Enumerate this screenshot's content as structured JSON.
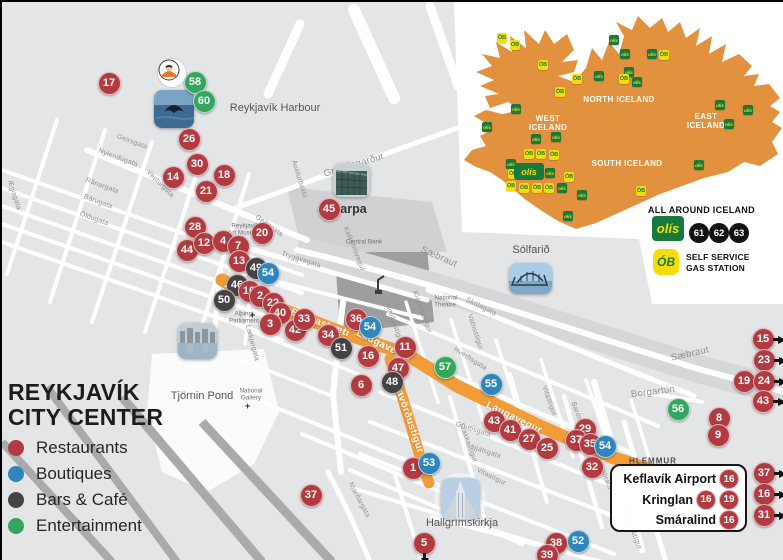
{
  "colors": {
    "restaurant": "#b13b41",
    "boutique": "#2f86ba",
    "bar": "#464244",
    "entertainment": "#34a65d",
    "route": "#f19c38",
    "iceland": "#e2913e",
    "olis_green": "#17793c",
    "olis_yellow": "#f5dd0a"
  },
  "city_legend": {
    "title_line1": "REYKJAVÍK",
    "title_line2": "CITY CENTER",
    "items": [
      {
        "label": "Restaurants",
        "color": "#b13b41"
      },
      {
        "label": "Boutiques",
        "color": "#2f86ba"
      },
      {
        "label": "Bars & Café",
        "color": "#464244"
      },
      {
        "label": "Entertainment",
        "color": "#34a65d"
      }
    ]
  },
  "map": {
    "street_labels": [
      {
        "t": "Grandagarður",
        "x": 352,
        "y": 163,
        "r": -17,
        "s": "md"
      },
      {
        "t": "Geirsgata",
        "x": 130,
        "y": 140,
        "r": 20,
        "s": "sm"
      },
      {
        "t": "Nýlendugata",
        "x": 116,
        "y": 156,
        "r": 20,
        "s": "sm"
      },
      {
        "t": "Ránargata",
        "x": 100,
        "y": 184,
        "r": 20,
        "s": "sm"
      },
      {
        "t": "Bárugata",
        "x": 96,
        "y": 200,
        "r": 20,
        "s": "sm"
      },
      {
        "t": "Öldugata",
        "x": 92,
        "y": 217,
        "r": 20,
        "s": "sm"
      },
      {
        "t": "Vesturgata",
        "x": 158,
        "y": 182,
        "r": 45,
        "s": "sm"
      },
      {
        "t": "Ægisgata",
        "x": 12,
        "y": 193,
        "r": 72,
        "s": "sm"
      },
      {
        "t": "Geirsgata",
        "x": 267,
        "y": 224,
        "r": 36,
        "s": "sm"
      },
      {
        "t": "Austurbakki",
        "x": 297,
        "y": 177,
        "r": 73,
        "s": "sm"
      },
      {
        "t": "Tryggvagata",
        "x": 299,
        "y": 258,
        "r": 18,
        "s": "sm"
      },
      {
        "t": "Kalkofnsvegur",
        "x": 352,
        "y": 247,
        "r": 68,
        "s": "sm"
      },
      {
        "t": "Sæbraut",
        "x": 437,
        "y": 255,
        "r": 24,
        "s": "md"
      },
      {
        "t": "Skúlagata",
        "x": 479,
        "y": 305,
        "r": 26,
        "s": "sm"
      },
      {
        "t": "Hverfisgata",
        "x": 468,
        "y": 357,
        "r": 32,
        "s": "sm"
      },
      {
        "t": "Klapparstígur",
        "x": 420,
        "y": 310,
        "r": 70,
        "s": "sm"
      },
      {
        "t": "Smiðjustígur",
        "x": 392,
        "y": 322,
        "r": 70,
        "s": "sm"
      },
      {
        "t": "Vatnsstígur",
        "x": 473,
        "y": 330,
        "r": 72,
        "s": "sm"
      },
      {
        "t": "Sæbraut",
        "x": 688,
        "y": 352,
        "r": -13,
        "s": "md"
      },
      {
        "t": "Borgartún",
        "x": 651,
        "y": 390,
        "r": -7,
        "s": "md"
      },
      {
        "t": "Vitastígur",
        "x": 547,
        "y": 399,
        "r": 70,
        "s": "sm"
      },
      {
        "t": "Frakkastígur",
        "x": 466,
        "y": 441,
        "r": 70,
        "s": "sm"
      },
      {
        "t": "Barónsstígur",
        "x": 578,
        "y": 420,
        "r": 70,
        "s": "sm"
      },
      {
        "t": "Snorrabraut",
        "x": 601,
        "y": 469,
        "r": 70,
        "s": "sm"
      },
      {
        "t": "Rauðarárstígur",
        "x": 629,
        "y": 524,
        "r": 70,
        "s": "sm"
      },
      {
        "t": "Njálsgata",
        "x": 484,
        "y": 450,
        "r": 18,
        "s": "sm"
      },
      {
        "t": "Grettisgata",
        "x": 471,
        "y": 428,
        "r": 18,
        "s": "sm"
      },
      {
        "t": "Njarðargata",
        "x": 357,
        "y": 498,
        "r": 62,
        "s": "sm"
      },
      {
        "t": "Vitastígur",
        "x": 489,
        "y": 475,
        "r": 26,
        "s": "sm"
      },
      {
        "t": "Lækjargata",
        "x": 250,
        "y": 341,
        "r": 75,
        "s": "sm"
      }
    ],
    "place_labels": [
      {
        "t": "Reykjavík Harbour",
        "x": 273,
        "y": 106,
        "r": 0,
        "s": "p"
      },
      {
        "t": "Harpa",
        "x": 347,
        "y": 207,
        "r": 0,
        "s": "pb"
      },
      {
        "t": "Tjörnin Pond",
        "x": 200,
        "y": 394,
        "r": 0,
        "s": "p"
      },
      {
        "t": "Sólfarið",
        "x": 529,
        "y": 248,
        "r": 0,
        "s": "p"
      },
      {
        "t": "Hallgrímskirkja",
        "x": 460,
        "y": 521,
        "r": 0,
        "s": "p"
      },
      {
        "t": "Central Bank",
        "x": 362,
        "y": 240,
        "r": 0,
        "s": "t"
      },
      {
        "t": "National",
        "x": 444,
        "y": 296,
        "r": 0,
        "s": "t"
      },
      {
        "t": "Theatre",
        "x": 443,
        "y": 303,
        "r": 0,
        "s": "t"
      },
      {
        "t": "Alþingi",
        "x": 242,
        "y": 312,
        "r": 0,
        "s": "t"
      },
      {
        "t": "Parliament",
        "x": 242,
        "y": 319,
        "r": 0,
        "s": "t"
      },
      {
        "t": "National",
        "x": 249,
        "y": 389,
        "r": 0,
        "s": "t"
      },
      {
        "t": "Gallery",
        "x": 249,
        "y": 396,
        "r": 0,
        "s": "t"
      },
      {
        "t": "Reykjavík",
        "x": 243,
        "y": 224,
        "r": 0,
        "s": "t"
      },
      {
        "t": "Art Museum",
        "x": 243,
        "y": 231,
        "r": 0,
        "s": "t"
      },
      {
        "t": "HLEMMUR",
        "x": 651,
        "y": 459,
        "r": 0,
        "s": "tc"
      }
    ],
    "route_labels": [
      {
        "t": "Austurstræti",
        "x": 253,
        "y": 294,
        "r": 21
      },
      {
        "t": "Bankastræti",
        "x": 318,
        "y": 321,
        "r": 21
      },
      {
        "t": "Laugavegur",
        "x": 382,
        "y": 344,
        "r": 26
      },
      {
        "t": "Skólavörðustígur",
        "x": 404,
        "y": 409,
        "r": 71
      },
      {
        "t": "Laugavegur",
        "x": 512,
        "y": 416,
        "r": 26
      }
    ],
    "markers": [
      {
        "n": "17",
        "x": 107,
        "y": 81,
        "c": "restaurant"
      },
      {
        "n": "58",
        "x": 193,
        "y": 80,
        "c": "entertainment"
      },
      {
        "n": "60",
        "x": 202,
        "y": 99,
        "c": "entertainment"
      },
      {
        "n": "26",
        "x": 187,
        "y": 137,
        "c": "restaurant"
      },
      {
        "n": "30",
        "x": 195,
        "y": 162,
        "c": "restaurant"
      },
      {
        "n": "14",
        "x": 171,
        "y": 175,
        "c": "restaurant"
      },
      {
        "n": "18",
        "x": 222,
        "y": 173,
        "c": "restaurant"
      },
      {
        "n": "21",
        "x": 204,
        "y": 189,
        "c": "restaurant"
      },
      {
        "n": "45",
        "x": 327,
        "y": 207,
        "c": "restaurant"
      },
      {
        "n": "28",
        "x": 193,
        "y": 225,
        "c": "restaurant"
      },
      {
        "n": "20",
        "x": 260,
        "y": 231,
        "c": "restaurant"
      },
      {
        "n": "44",
        "x": 185,
        "y": 248,
        "c": "restaurant"
      },
      {
        "n": "12",
        "x": 202,
        "y": 241,
        "c": "restaurant"
      },
      {
        "n": "4",
        "x": 221,
        "y": 239,
        "c": "restaurant"
      },
      {
        "n": "7",
        "x": 236,
        "y": 244,
        "c": "restaurant"
      },
      {
        "n": "13",
        "x": 237,
        "y": 259,
        "c": "restaurant"
      },
      {
        "n": "49",
        "x": 254,
        "y": 266,
        "c": "bar"
      },
      {
        "n": "54",
        "x": 266,
        "y": 271,
        "c": "boutique"
      },
      {
        "n": "46",
        "x": 235,
        "y": 283,
        "c": "bar"
      },
      {
        "n": "10",
        "x": 247,
        "y": 289,
        "c": "restaurant"
      },
      {
        "n": "2",
        "x": 258,
        "y": 294,
        "c": "restaurant"
      },
      {
        "n": "50",
        "x": 222,
        "y": 298,
        "c": "bar"
      },
      {
        "n": "22",
        "x": 271,
        "y": 301,
        "c": "restaurant"
      },
      {
        "n": "40",
        "x": 278,
        "y": 311,
        "c": "restaurant"
      },
      {
        "n": "3",
        "x": 268,
        "y": 322,
        "c": "restaurant"
      },
      {
        "n": "42",
        "x": 293,
        "y": 328,
        "c": "restaurant"
      },
      {
        "n": "33",
        "x": 302,
        "y": 317,
        "c": "restaurant"
      },
      {
        "n": "34",
        "x": 326,
        "y": 333,
        "c": "restaurant"
      },
      {
        "n": "36",
        "x": 354,
        "y": 317,
        "c": "restaurant"
      },
      {
        "n": "54",
        "x": 368,
        "y": 325,
        "c": "boutique"
      },
      {
        "n": "51",
        "x": 339,
        "y": 346,
        "c": "bar"
      },
      {
        "n": "11",
        "x": 403,
        "y": 345,
        "c": "restaurant"
      },
      {
        "n": "16",
        "x": 366,
        "y": 354,
        "c": "restaurant"
      },
      {
        "n": "47",
        "x": 396,
        "y": 366,
        "c": "restaurant"
      },
      {
        "n": "48",
        "x": 390,
        "y": 380,
        "c": "bar"
      },
      {
        "n": "6",
        "x": 359,
        "y": 383,
        "c": "restaurant"
      },
      {
        "n": "57",
        "x": 443,
        "y": 365,
        "c": "entertainment"
      },
      {
        "n": "55",
        "x": 489,
        "y": 382,
        "c": "boutique"
      },
      {
        "n": "43",
        "x": 492,
        "y": 419,
        "c": "restaurant"
      },
      {
        "n": "41",
        "x": 508,
        "y": 428,
        "c": "restaurant"
      },
      {
        "n": "27",
        "x": 527,
        "y": 437,
        "c": "restaurant"
      },
      {
        "n": "25",
        "x": 545,
        "y": 446,
        "c": "restaurant"
      },
      {
        "n": "29",
        "x": 583,
        "y": 427,
        "c": "restaurant"
      },
      {
        "n": "37",
        "x": 574,
        "y": 438,
        "c": "restaurant"
      },
      {
        "n": "35",
        "x": 588,
        "y": 442,
        "c": "restaurant"
      },
      {
        "n": "54",
        "x": 603,
        "y": 444,
        "c": "boutique"
      },
      {
        "n": "32",
        "x": 590,
        "y": 465,
        "c": "restaurant"
      },
      {
        "n": "1",
        "x": 411,
        "y": 466,
        "c": "restaurant"
      },
      {
        "n": "53",
        "x": 427,
        "y": 461,
        "c": "boutique"
      },
      {
        "n": "37",
        "x": 309,
        "y": 493,
        "c": "restaurant"
      },
      {
        "n": "5",
        "x": 422,
        "y": 541,
        "c": "restaurant",
        "a": "down"
      },
      {
        "n": "38",
        "x": 554,
        "y": 541,
        "c": "restaurant"
      },
      {
        "n": "52",
        "x": 576,
        "y": 539,
        "c": "boutique"
      },
      {
        "n": "39",
        "x": 545,
        "y": 553,
        "c": "restaurant"
      },
      {
        "n": "56",
        "x": 676,
        "y": 407,
        "c": "entertainment"
      },
      {
        "n": "8",
        "x": 717,
        "y": 416,
        "c": "restaurant"
      },
      {
        "n": "9",
        "x": 716,
        "y": 433,
        "c": "restaurant"
      },
      {
        "n": "19",
        "x": 742,
        "y": 379,
        "c": "restaurant"
      },
      {
        "n": "15",
        "x": 761,
        "y": 337,
        "c": "restaurant",
        "a": "right"
      },
      {
        "n": "23",
        "x": 762,
        "y": 358,
        "c": "restaurant",
        "a": "right"
      },
      {
        "n": "24",
        "x": 762,
        "y": 379,
        "c": "restaurant",
        "a": "right"
      },
      {
        "n": "43",
        "x": 761,
        "y": 399,
        "c": "restaurant",
        "a": "right"
      },
      {
        "n": "37",
        "x": 762,
        "y": 471,
        "c": "restaurant",
        "a": "right"
      },
      {
        "n": "16",
        "x": 762,
        "y": 492,
        "c": "restaurant",
        "a": "right"
      },
      {
        "n": "31",
        "x": 762,
        "y": 513,
        "c": "restaurant",
        "a": "right"
      }
    ]
  },
  "inset": {
    "regions": [
      {
        "lines": [
          "NORTH ICELAND"
        ],
        "x": 617,
        "y": 93
      },
      {
        "lines": [
          "WEST",
          "ICELAND"
        ],
        "x": 546,
        "y": 112
      },
      {
        "lines": [
          "EAST",
          "ICELAND"
        ],
        "x": 704,
        "y": 110
      },
      {
        "lines": [
          "SOUTH ICELAND"
        ],
        "x": 625,
        "y": 157
      }
    ],
    "stations": [
      {
        "x": 500,
        "y": 36,
        "t": "ob"
      },
      {
        "x": 513,
        "y": 43,
        "t": "ob"
      },
      {
        "x": 541,
        "y": 63,
        "t": "ob"
      },
      {
        "x": 558,
        "y": 90,
        "t": "ob"
      },
      {
        "x": 575,
        "y": 77,
        "t": "ob"
      },
      {
        "x": 597,
        "y": 74,
        "t": "olis"
      },
      {
        "x": 612,
        "y": 38,
        "t": "olis"
      },
      {
        "x": 623,
        "y": 52,
        "t": "olis"
      },
      {
        "x": 627,
        "y": 70,
        "t": "olis"
      },
      {
        "x": 622,
        "y": 77,
        "t": "ob"
      },
      {
        "x": 635,
        "y": 80,
        "t": "olis"
      },
      {
        "x": 650,
        "y": 52,
        "t": "olis"
      },
      {
        "x": 662,
        "y": 53,
        "t": "ob"
      },
      {
        "x": 718,
        "y": 103,
        "t": "olis"
      },
      {
        "x": 746,
        "y": 108,
        "t": "olis"
      },
      {
        "x": 514,
        "y": 107,
        "t": "olis"
      },
      {
        "x": 485,
        "y": 125,
        "t": "olis"
      },
      {
        "x": 534,
        "y": 137,
        "t": "olis"
      },
      {
        "x": 554,
        "y": 135,
        "t": "olis"
      },
      {
        "x": 527,
        "y": 152,
        "t": "ob"
      },
      {
        "x": 539,
        "y": 152,
        "t": "ob"
      },
      {
        "x": 552,
        "y": 153,
        "t": "ob"
      },
      {
        "x": 509,
        "y": 162,
        "t": "olis"
      },
      {
        "x": 511,
        "y": 172,
        "t": "ob"
      },
      {
        "x": 548,
        "y": 171,
        "t": "olis"
      },
      {
        "x": 567,
        "y": 175,
        "t": "ob"
      },
      {
        "x": 509,
        "y": 184,
        "t": "ob"
      },
      {
        "x": 522,
        "y": 186,
        "t": "ob"
      },
      {
        "x": 535,
        "y": 186,
        "t": "ob"
      },
      {
        "x": 547,
        "y": 186,
        "t": "ob"
      },
      {
        "x": 560,
        "y": 186,
        "t": "olis"
      },
      {
        "x": 580,
        "y": 193,
        "t": "olis"
      },
      {
        "x": 639,
        "y": 189,
        "t": "ob"
      },
      {
        "x": 566,
        "y": 214,
        "t": "olis"
      },
      {
        "x": 697,
        "y": 163,
        "t": "olis"
      },
      {
        "x": 727,
        "y": 122,
        "t": "olis"
      }
    ],
    "brand": "olís",
    "ob_brand": "ÓB",
    "legend": {
      "all_around": "ALL AROUND ICELAND",
      "numbers": [
        "61",
        "62",
        "63"
      ],
      "self_service_1": "SELF SERVICE",
      "self_service_2": "GAS STATION"
    }
  },
  "info_box": {
    "rows": [
      {
        "label": "Keflavík Airport",
        "badges": [
          "16"
        ]
      },
      {
        "label": "Kringlan",
        "badges": [
          "16",
          "19"
        ]
      },
      {
        "label": "Smáralind",
        "badges": [
          "16"
        ]
      }
    ]
  }
}
